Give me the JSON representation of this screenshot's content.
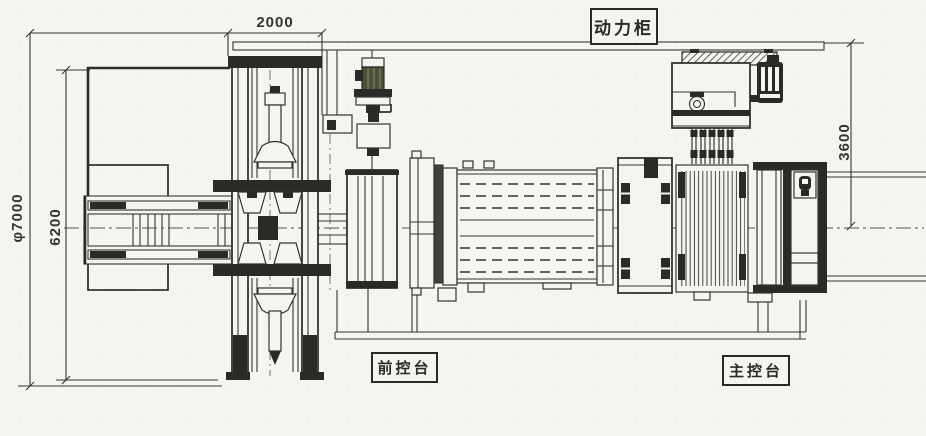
{
  "drawing": {
    "kind": "machine-layout-engineering-drawing",
    "labels": {
      "power_cabinet": "动力柜",
      "front_console": "前控台",
      "main_console": "主控台"
    },
    "dimensions": {
      "top_width": "2000",
      "right_height": "3600",
      "left_inner_height": "6200",
      "left_outer_diameter": "φ7000"
    },
    "colors": {
      "paper": "#f6f4ef",
      "ink": "#35342f",
      "ink-dark": "#2b2a27",
      "motor": "#4d5038"
    }
  }
}
